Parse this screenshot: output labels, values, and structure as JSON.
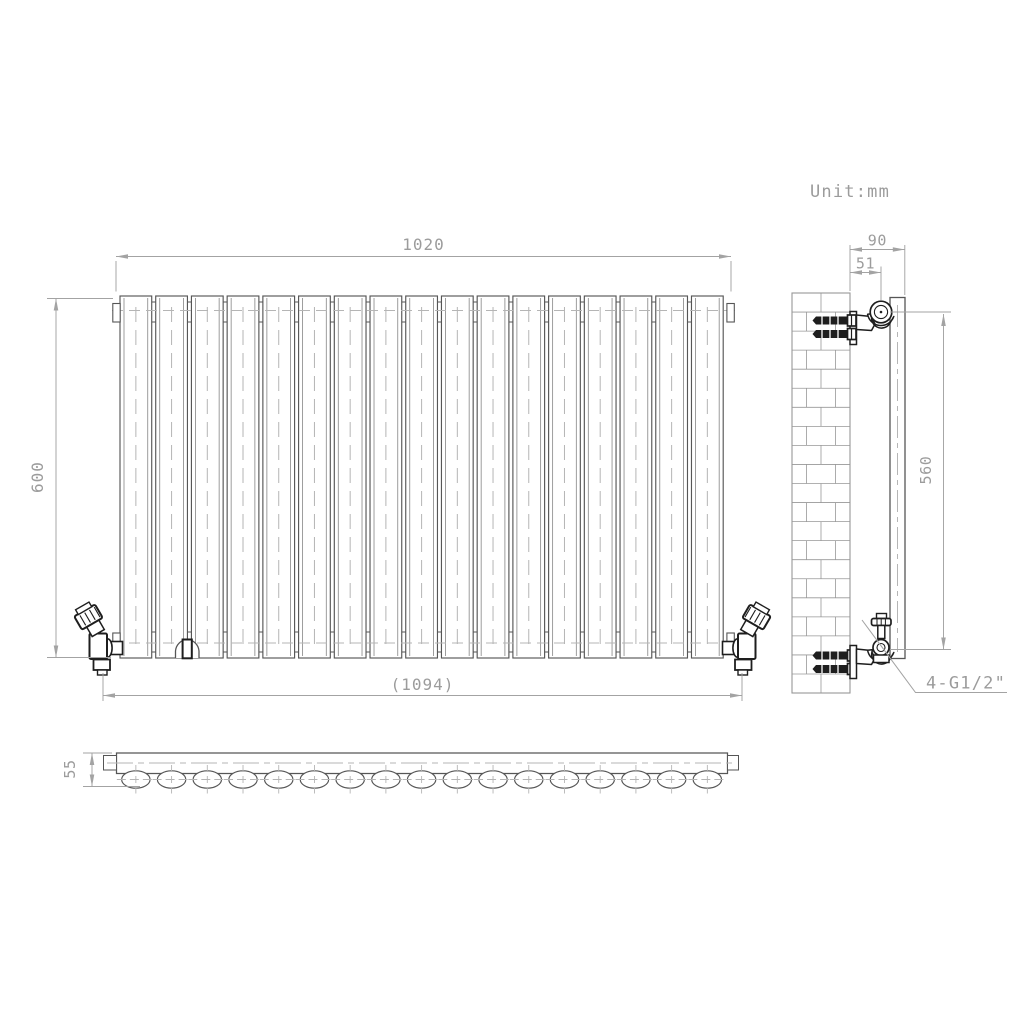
{
  "title": "Radiator dimensional technical drawing",
  "unit_note": "Unit:mm",
  "front_view": {
    "panel_count": 17,
    "dim_width_top": "1020",
    "dim_height": "600",
    "dim_width_overall": "(1094)"
  },
  "top_view": {
    "tube_count": 17,
    "dim_depth": "55"
  },
  "side_view": {
    "dim_bracket_depth": "90",
    "dim_wall_to_tube_center": "51",
    "dim_connection_spacing": "560",
    "connection_label": "4-G1/2\""
  },
  "colors": {
    "outline": "#565656",
    "inner_line": "#8c8c8c",
    "centerline": "#b5b5b5",
    "dimension": "#a3a3a3",
    "text": "#9c9c9c",
    "dark_detail": "#1e1e1e",
    "brick": "#979797",
    "background": "#ffffff"
  }
}
